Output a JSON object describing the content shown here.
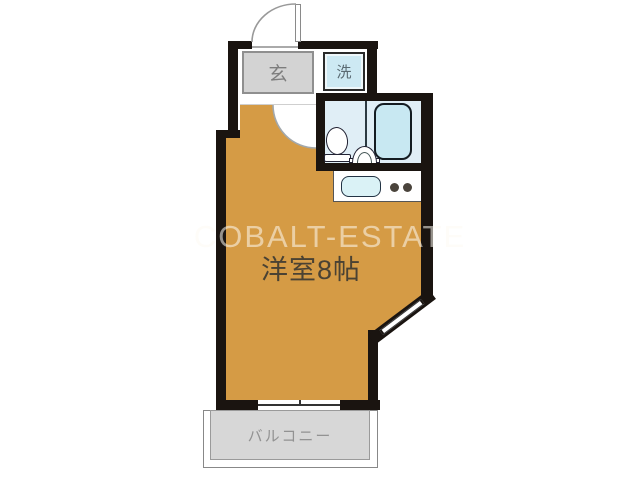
{
  "floorplan": {
    "watermark_text": "COBALT-ESTATE",
    "rooms": {
      "entrance_label": "玄",
      "washer_label": "洗",
      "main_room_label": "洋室8帖",
      "balcony_label": "バルコニー"
    },
    "colors": {
      "room_fill": "#d59b45",
      "wall": "#1a1410",
      "entrance_fill": "#d3d3d3",
      "washer_fill": "#cde9f3",
      "bathroom_fill": "#e0eef6",
      "bathtub_fill": "#c8e8f2",
      "sink_fill": "#daf2f6",
      "balcony_fill": "#d7d7d7",
      "background": "#ffffff"
    }
  }
}
